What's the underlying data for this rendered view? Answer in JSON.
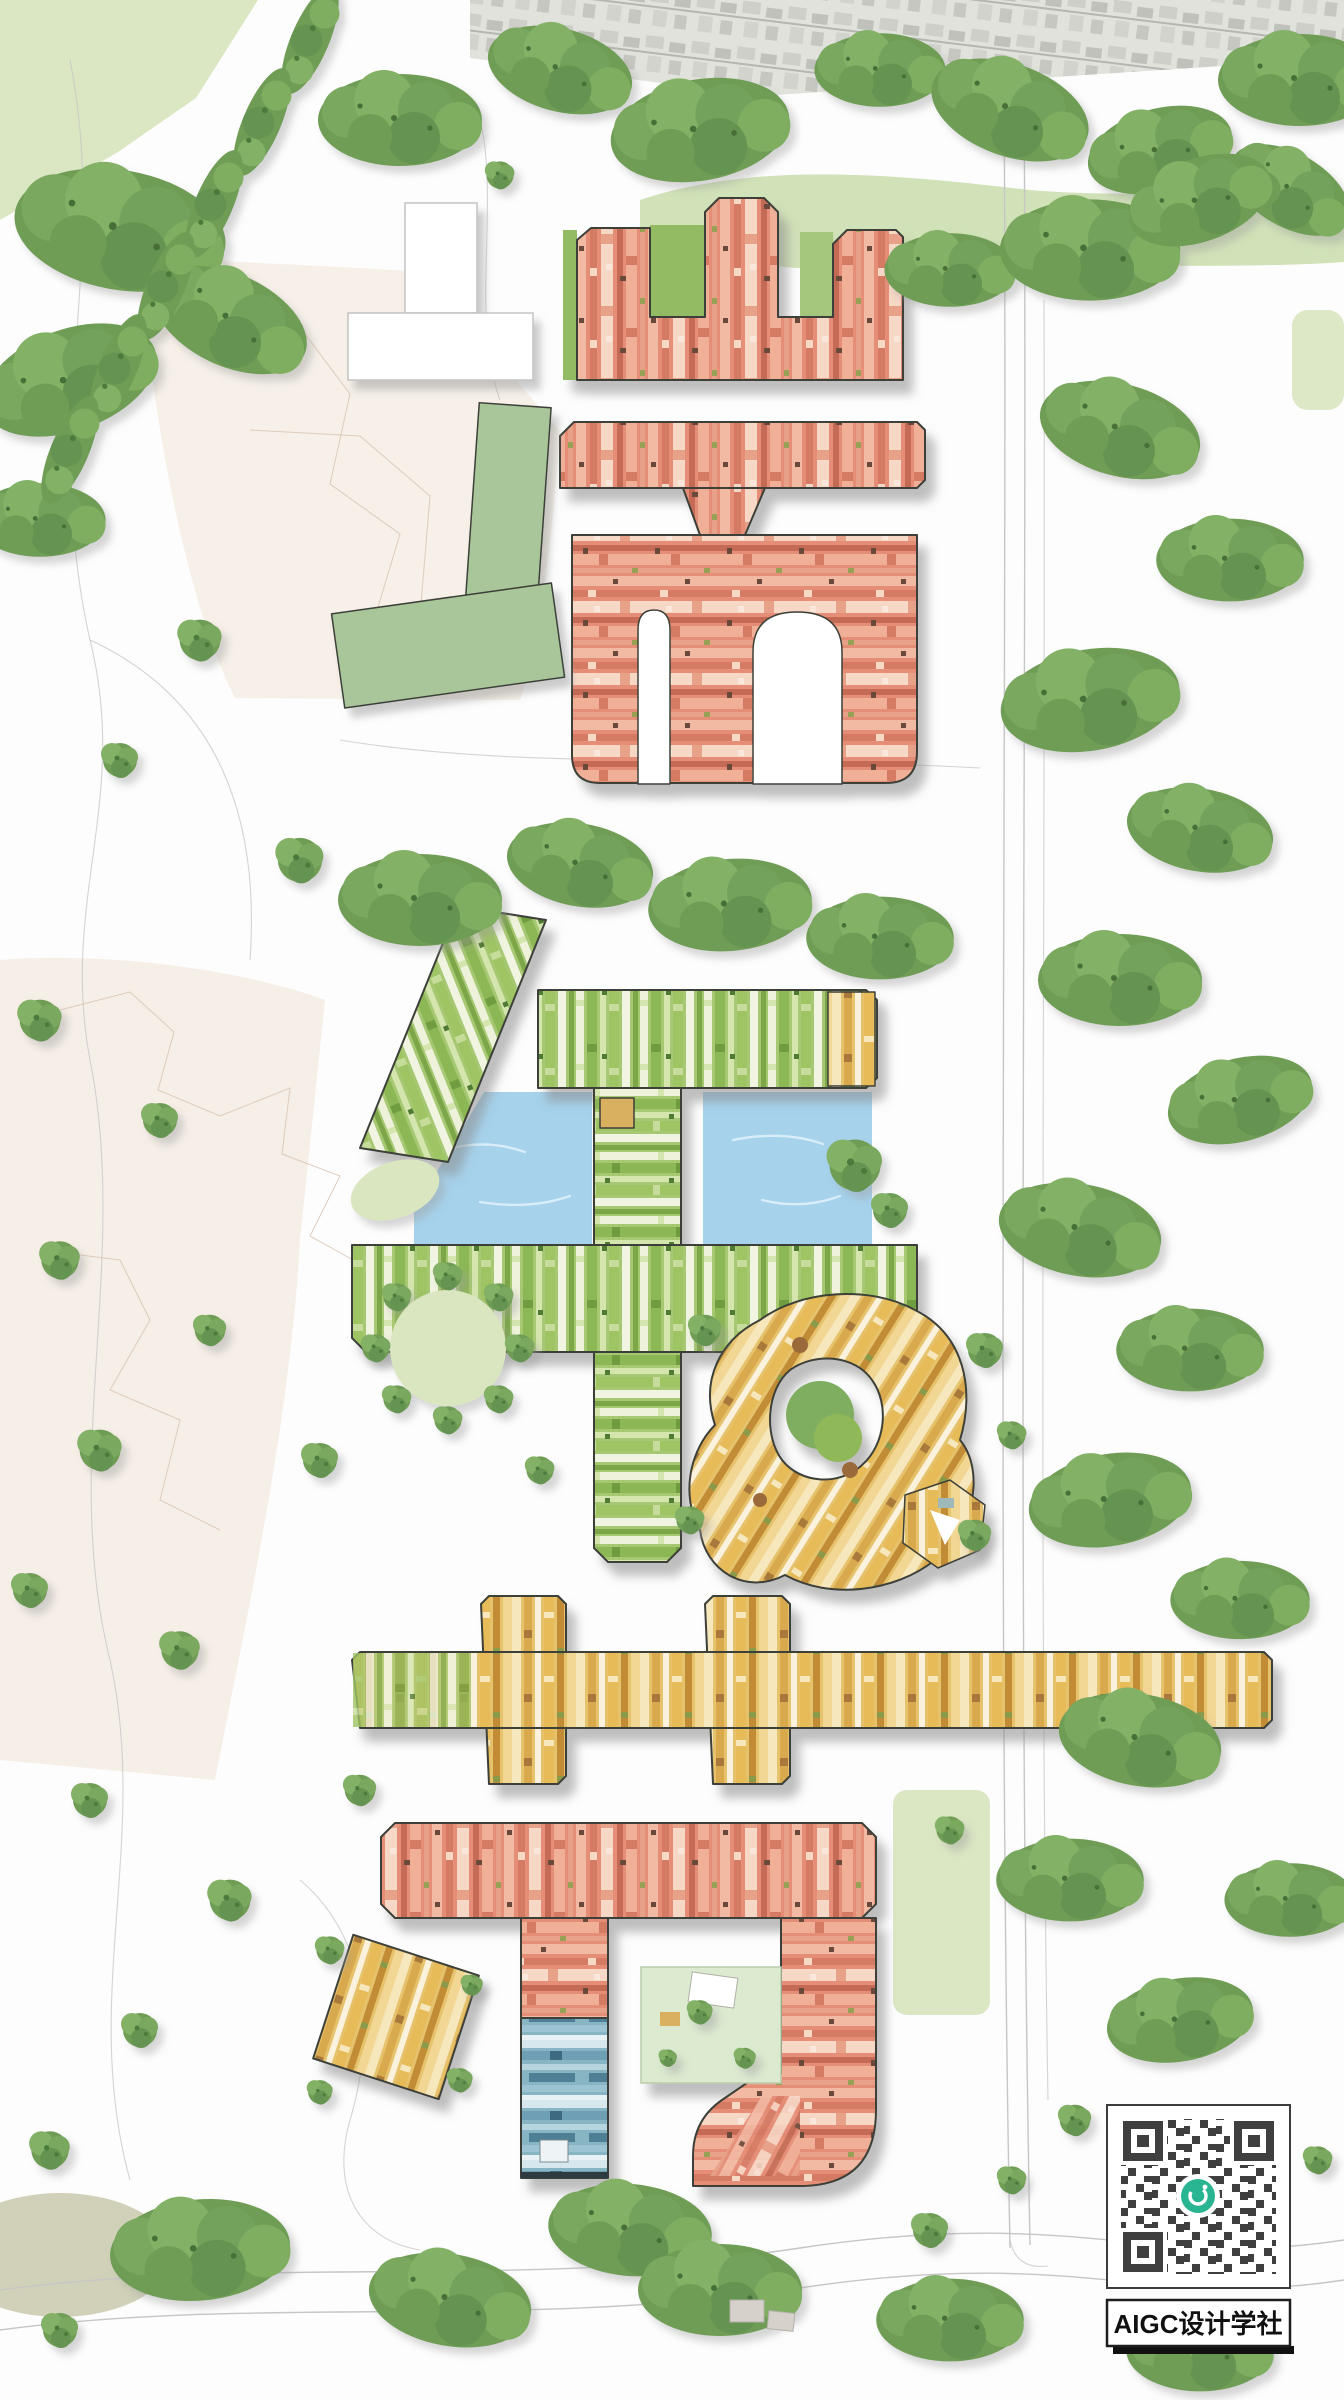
{
  "meta": {
    "kind": "architectural-masterplan-aerial-rendering",
    "description": "Site plan with building clusters shaped like Chinese characters, woodland, ponds and roads"
  },
  "watermark": {
    "qr_label": "AIGC设计学社",
    "qr_center_logo": "teal-ring-logo"
  },
  "clusters": [
    {
      "id": "shan-top",
      "shape": "three-pronged (山-like)",
      "color_theme": "coral red stripes"
    },
    {
      "id": "er-upper",
      "shape": "bar + slotted block (而-like)",
      "color_theme": "coral red stripes"
    },
    {
      "id": "qian-green",
      "shape": "slanted arm + bars + stem (千-like)",
      "color_theme": "green stripes",
      "features": [
        "two blue ponds"
      ]
    },
    {
      "id": "round-village",
      "shape": "circular swirl with green courtyard",
      "color_theme": "golden yellow"
    },
    {
      "id": "jing-yellow",
      "shape": "long bar with two crossings (井-like)",
      "color_theme": "yellow stripes, green west end"
    },
    {
      "id": "jie-bottom",
      "shape": "bar + hooked block (节-like)",
      "color_theme": "coral red stripes",
      "features": [
        "blue striped wing",
        "green courtyard"
      ]
    },
    {
      "id": "hamlet-tilted",
      "shape": "small tilted block",
      "color_theme": "tan yellow"
    }
  ],
  "palette": {
    "outline": "#3c4038",
    "red_base": "#e58d77",
    "red_light": "#f2b9a3",
    "red_pale": "#f7d7c6",
    "red_dark": "#d57a63",
    "red_deep": "#c46a55",
    "green_base": "#a7c873",
    "green_bright": "#8cb755",
    "green_pale": "#eef2da",
    "green_mid": "#9fc464",
    "green_deep": "#7ba647",
    "yellow_base": "#e7c26d",
    "yellow_light": "#f6e7bc",
    "yellow_dark": "#d9a94e",
    "yellow_deep": "#c18c36",
    "cream": "#faf2dc",
    "blue_base": "#88b5c4",
    "blue_light": "#d6e8ee",
    "blue_mid": "#6e9fb4",
    "blue_deep": "#4f7f95",
    "water": "#a6d2ec",
    "tree_base": "#6f9d55",
    "tree_light": "#83b166",
    "tree_dark": "#4c7a3c",
    "lawn": "#d9e6c0",
    "meadow": "#cfe0b4",
    "sage": "#a9c69b",
    "beige": "#f6efe7",
    "beige_line": "#d8c5b4",
    "road_line": "#c6c6c6",
    "city_gray": "#c6c7c0",
    "qr_dark": "#3f3f3f",
    "qr_teal": "#2ab592",
    "ink": "#111111"
  }
}
